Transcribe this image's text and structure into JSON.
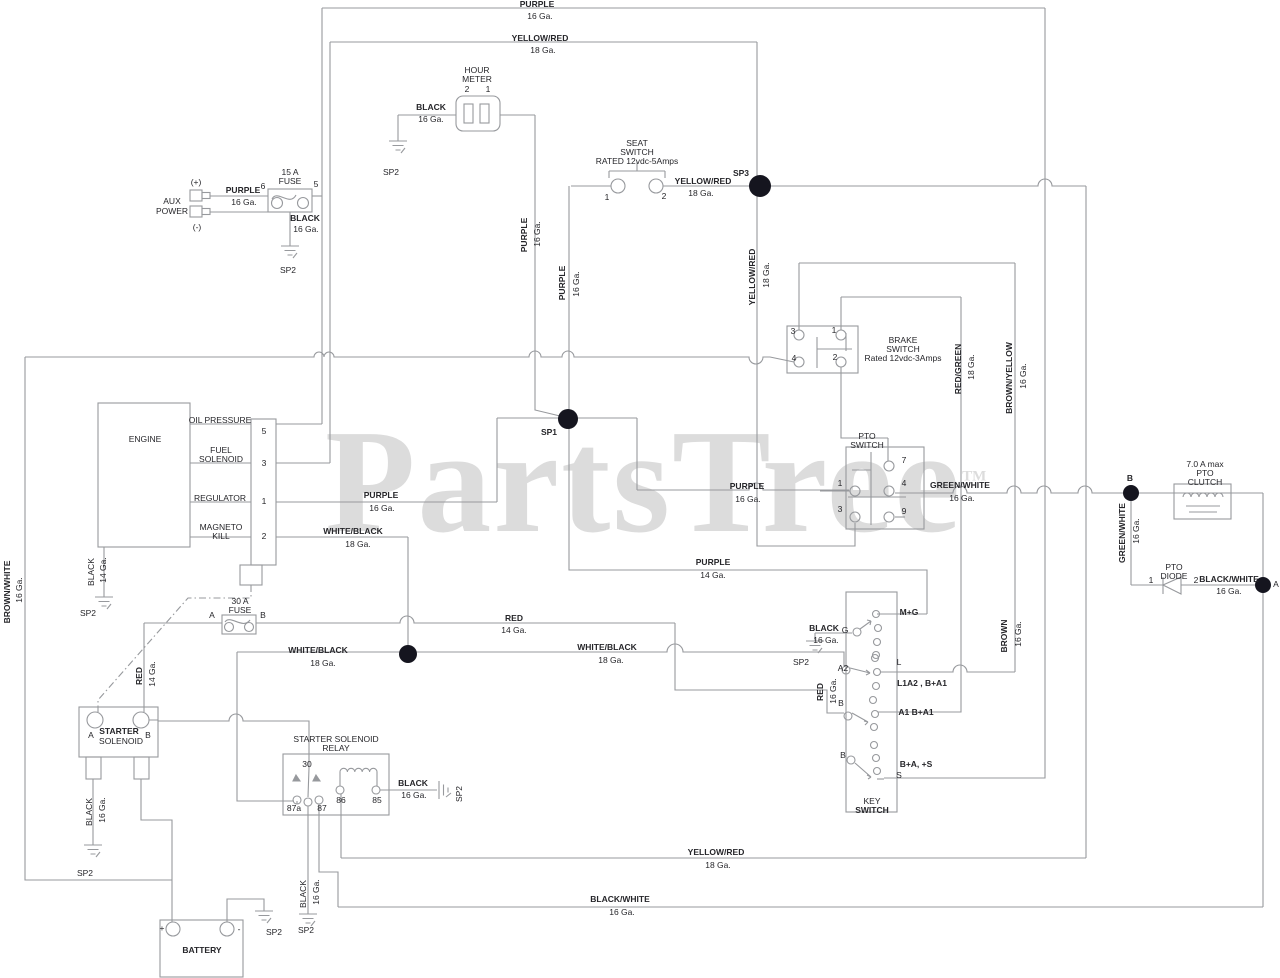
{
  "document": {
    "type": "electrical wiring schematic",
    "source_watermark": "PartsTree"
  },
  "watermark": {
    "text": "PartsTree",
    "tm": "TM"
  },
  "colors": {
    "wire": "#97999d",
    "text": "#26262a",
    "junction_dot": "#15151f",
    "watermark": "#dcdcdc"
  },
  "components": [
    "HOUR METER",
    "AUX POWER",
    "15 A FUSE",
    "SEAT SWITCH RATED 12vdc-5Amps",
    "BRAKE SWITCH Rated 12vdc-3Amps",
    "ENGINE",
    "PTO SWITCH",
    "7.0 A max PTO CLUTCH",
    "PTO DIODE",
    "KEY SWITCH",
    "30 A FUSE",
    "STARTER SOLENOID",
    "STARTER SOLENOID RELAY",
    "BATTERY"
  ],
  "junctions": [
    "SP1",
    "SP3",
    "A",
    "B"
  ],
  "grounds": [
    "SP2"
  ],
  "labels": [
    {
      "t": "PURPLE",
      "x": 537,
      "y": 4,
      "b": 1,
      "r": 0
    },
    {
      "t": "16 Ga.",
      "x": 540,
      "y": 16,
      "b": 0,
      "r": 0
    },
    {
      "t": "YELLOW/RED",
      "x": 540,
      "y": 38,
      "b": 1,
      "r": 0
    },
    {
      "t": "18 Ga.",
      "x": 543,
      "y": 50,
      "b": 0,
      "r": 0
    },
    {
      "t": "HOUR",
      "x": 477,
      "y": 70,
      "b": 0,
      "r": 0
    },
    {
      "t": "METER",
      "x": 477,
      "y": 79,
      "b": 0,
      "r": 0
    },
    {
      "t": "2",
      "x": 467,
      "y": 89,
      "b": 0,
      "r": 0
    },
    {
      "t": "1",
      "x": 488,
      "y": 89,
      "b": 0,
      "r": 0
    },
    {
      "t": "BLACK",
      "x": 431,
      "y": 107,
      "b": 1,
      "r": 0
    },
    {
      "t": "16 Ga.",
      "x": 431,
      "y": 119,
      "b": 0,
      "r": 0
    },
    {
      "t": "SP2",
      "x": 391,
      "y": 172,
      "b": 0,
      "r": 0
    },
    {
      "t": "(+)",
      "x": 196,
      "y": 182,
      "b": 0,
      "r": 0
    },
    {
      "t": "AUX",
      "x": 172,
      "y": 201,
      "b": 0,
      "r": 0
    },
    {
      "t": "POWER",
      "x": 172,
      "y": 211,
      "b": 0,
      "r": 0
    },
    {
      "t": "(-)",
      "x": 197,
      "y": 227,
      "b": 0,
      "r": 0
    },
    {
      "t": "PURPLE",
      "x": 243,
      "y": 190,
      "b": 1,
      "r": 0
    },
    {
      "t": "16 Ga.",
      "x": 244,
      "y": 202,
      "b": 0,
      "r": 0
    },
    {
      "t": "15 A",
      "x": 290,
      "y": 172,
      "b": 0,
      "r": 0
    },
    {
      "t": "FUSE",
      "x": 290,
      "y": 181,
      "b": 0,
      "r": 0
    },
    {
      "t": "6",
      "x": 263,
      "y": 186,
      "b": 0,
      "r": 0
    },
    {
      "t": "5",
      "x": 316,
      "y": 184,
      "b": 0,
      "r": 0
    },
    {
      "t": "BLACK",
      "x": 305,
      "y": 218,
      "b": 1,
      "r": 0
    },
    {
      "t": "16 Ga.",
      "x": 306,
      "y": 229,
      "b": 0,
      "r": 0
    },
    {
      "t": "SP2",
      "x": 288,
      "y": 270,
      "b": 0,
      "r": 0
    },
    {
      "t": "SEAT",
      "x": 637,
      "y": 143,
      "b": 0,
      "r": 0
    },
    {
      "t": "SWITCH",
      "x": 637,
      "y": 152,
      "b": 0,
      "r": 0
    },
    {
      "t": "RATED 12vdc-5Amps",
      "x": 637,
      "y": 161,
      "b": 0,
      "r": 0
    },
    {
      "t": "1",
      "x": 607,
      "y": 197,
      "b": 0,
      "r": 0
    },
    {
      "t": "2",
      "x": 664,
      "y": 196,
      "b": 0,
      "r": 0
    },
    {
      "t": "YELLOW/RED",
      "x": 703,
      "y": 181,
      "b": 1,
      "r": 0
    },
    {
      "t": "18 Ga.",
      "x": 701,
      "y": 193,
      "b": 0,
      "r": 0
    },
    {
      "t": "SP3",
      "x": 741,
      "y": 173,
      "b": 1,
      "r": 0
    },
    {
      "t": "YELLOW/RED",
      "x": 752,
      "y": 277,
      "b": 1,
      "r": 1
    },
    {
      "t": "18 Ga.",
      "x": 766,
      "y": 275,
      "b": 0,
      "r": 1
    },
    {
      "t": "3",
      "x": 793,
      "y": 331,
      "b": 0,
      "r": 0
    },
    {
      "t": "1",
      "x": 834,
      "y": 330,
      "b": 0,
      "r": 0
    },
    {
      "t": "4",
      "x": 794,
      "y": 358,
      "b": 0,
      "r": 0
    },
    {
      "t": "2",
      "x": 835,
      "y": 357,
      "b": 0,
      "r": 0
    },
    {
      "t": "BRAKE",
      "x": 903,
      "y": 340,
      "b": 0,
      "r": 0
    },
    {
      "t": "SWITCH",
      "x": 903,
      "y": 349,
      "b": 0,
      "r": 0
    },
    {
      "t": "Rated 12vdc-3Amps",
      "x": 903,
      "y": 358,
      "b": 0,
      "r": 0
    },
    {
      "t": "RED/GREEN",
      "x": 958,
      "y": 369,
      "b": 1,
      "r": 1
    },
    {
      "t": "18 Ga.",
      "x": 971,
      "y": 367,
      "b": 0,
      "r": 1
    },
    {
      "t": "BROWN/YELLOW",
      "x": 1009,
      "y": 378,
      "b": 1,
      "r": 1
    },
    {
      "t": "16 Ga.",
      "x": 1023,
      "y": 376,
      "b": 0,
      "r": 1
    },
    {
      "t": "ENGINE",
      "x": 145,
      "y": 439,
      "b": 0,
      "r": 0
    },
    {
      "t": "OIL PRESSURE",
      "x": 220,
      "y": 420,
      "b": 0,
      "r": 0
    },
    {
      "t": "FUEL",
      "x": 221,
      "y": 450,
      "b": 0,
      "r": 0
    },
    {
      "t": "SOLENOID",
      "x": 221,
      "y": 459,
      "b": 0,
      "r": 0
    },
    {
      "t": "REGULATOR",
      "x": 220,
      "y": 498,
      "b": 0,
      "r": 0
    },
    {
      "t": "MAGNETO",
      "x": 221,
      "y": 527,
      "b": 0,
      "r": 0
    },
    {
      "t": "KILL",
      "x": 221,
      "y": 536,
      "b": 0,
      "r": 0
    },
    {
      "t": "5",
      "x": 264,
      "y": 431,
      "b": 0,
      "r": 0
    },
    {
      "t": "3",
      "x": 264,
      "y": 463,
      "b": 0,
      "r": 0
    },
    {
      "t": "1",
      "x": 264,
      "y": 501,
      "b": 0,
      "r": 0
    },
    {
      "t": "2",
      "x": 264,
      "y": 536,
      "b": 0,
      "r": 0
    },
    {
      "t": "BLACK",
      "x": 91,
      "y": 572,
      "b": 0,
      "r": 1
    },
    {
      "t": "14 Ga.",
      "x": 103,
      "y": 570,
      "b": 0,
      "r": 1
    },
    {
      "t": "SP2",
      "x": 88,
      "y": 613,
      "b": 0,
      "r": 0
    },
    {
      "t": "PURPLE",
      "x": 381,
      "y": 495,
      "b": 1,
      "r": 0
    },
    {
      "t": "16 Ga.",
      "x": 382,
      "y": 508,
      "b": 0,
      "r": 0
    },
    {
      "t": "WHITE/BLACK",
      "x": 353,
      "y": 531,
      "b": 1,
      "r": 0
    },
    {
      "t": "18 Ga.",
      "x": 358,
      "y": 544,
      "b": 0,
      "r": 0
    },
    {
      "t": "SP1",
      "x": 549,
      "y": 432,
      "b": 1,
      "r": 0
    },
    {
      "t": "PURPLE",
      "x": 524,
      "y": 235,
      "b": 1,
      "r": 1
    },
    {
      "t": "16 Ga.",
      "x": 537,
      "y": 234,
      "b": 0,
      "r": 1
    },
    {
      "t": "PURPLE",
      "x": 562,
      "y": 283,
      "b": 1,
      "r": 1
    },
    {
      "t": "16 Ga.",
      "x": 576,
      "y": 284,
      "b": 0,
      "r": 1
    },
    {
      "t": "PURPLE",
      "x": 747,
      "y": 486,
      "b": 1,
      "r": 0
    },
    {
      "t": "16 Ga.",
      "x": 748,
      "y": 499,
      "b": 0,
      "r": 0
    },
    {
      "t": "PTO",
      "x": 867,
      "y": 436,
      "b": 0,
      "r": 0
    },
    {
      "t": "SWITCH",
      "x": 867,
      "y": 445,
      "b": 0,
      "r": 0
    },
    {
      "t": "7",
      "x": 904,
      "y": 460,
      "b": 0,
      "r": 0
    },
    {
      "t": "1",
      "x": 840,
      "y": 483,
      "b": 0,
      "r": 0
    },
    {
      "t": "4",
      "x": 904,
      "y": 483,
      "b": 0,
      "r": 0
    },
    {
      "t": "3",
      "x": 840,
      "y": 509,
      "b": 0,
      "r": 0
    },
    {
      "t": "9",
      "x": 904,
      "y": 511,
      "b": 0,
      "r": 0
    },
    {
      "t": "GREEN/WHITE",
      "x": 960,
      "y": 485,
      "b": 1,
      "r": 0
    },
    {
      "t": "16 Ga.",
      "x": 962,
      "y": 498,
      "b": 0,
      "r": 0
    },
    {
      "t": "PURPLE",
      "x": 713,
      "y": 562,
      "b": 1,
      "r": 0
    },
    {
      "t": "14 Ga.",
      "x": 713,
      "y": 575,
      "b": 0,
      "r": 0
    },
    {
      "t": "7.0 A max",
      "x": 1205,
      "y": 464,
      "b": 0,
      "r": 0
    },
    {
      "t": "PTO",
      "x": 1205,
      "y": 473,
      "b": 0,
      "r": 0
    },
    {
      "t": "CLUTCH",
      "x": 1205,
      "y": 482,
      "b": 0,
      "r": 0
    },
    {
      "t": "B",
      "x": 1130,
      "y": 478,
      "b": 1,
      "r": 0
    },
    {
      "t": "GREEN/WHITE",
      "x": 1122,
      "y": 533,
      "b": 1,
      "r": 1
    },
    {
      "t": "16 Ga.",
      "x": 1136,
      "y": 531,
      "b": 0,
      "r": 1
    },
    {
      "t": "PTO",
      "x": 1174,
      "y": 567,
      "b": 0,
      "r": 0
    },
    {
      "t": "DIODE",
      "x": 1174,
      "y": 576,
      "b": 0,
      "r": 0
    },
    {
      "t": "1",
      "x": 1151,
      "y": 580,
      "b": 0,
      "r": 0
    },
    {
      "t": "2",
      "x": 1196,
      "y": 580,
      "b": 0,
      "r": 0
    },
    {
      "t": "BLACK/WHITE",
      "x": 1229,
      "y": 579,
      "b": 1,
      "r": 0
    },
    {
      "t": "16 Ga.",
      "x": 1229,
      "y": 591,
      "b": 0,
      "r": 0
    },
    {
      "t": "A",
      "x": 1276,
      "y": 584,
      "b": 0,
      "r": 0
    },
    {
      "t": "BLACK",
      "x": 824,
      "y": 628,
      "b": 1,
      "r": 0
    },
    {
      "t": "16 Ga.",
      "x": 826,
      "y": 640,
      "b": 0,
      "r": 0
    },
    {
      "t": "SP2",
      "x": 801,
      "y": 662,
      "b": 0,
      "r": 0
    },
    {
      "t": "G",
      "x": 845,
      "y": 630,
      "b": 0,
      "r": 0
    },
    {
      "t": "M+G",
      "x": 909,
      "y": 612,
      "b": 1,
      "r": 0
    },
    {
      "t": "A2",
      "x": 843,
      "y": 668,
      "b": 0,
      "r": 0
    },
    {
      "t": "L",
      "x": 899,
      "y": 662,
      "b": 0,
      "r": 0
    },
    {
      "t": "L1A2 , B+A1",
      "x": 922,
      "y": 683,
      "b": 1,
      "r": 0
    },
    {
      "t": "B",
      "x": 841,
      "y": 703,
      "b": 0,
      "r": 0
    },
    {
      "t": "A1 B+A1",
      "x": 916,
      "y": 712,
      "b": 1,
      "r": 0
    },
    {
      "t": "B",
      "x": 843,
      "y": 755,
      "b": 0,
      "r": 0
    },
    {
      "t": "B+A, +S",
      "x": 916,
      "y": 764,
      "b": 1,
      "r": 0
    },
    {
      "t": "S",
      "x": 899,
      "y": 775,
      "b": 0,
      "r": 0
    },
    {
      "t": "KEY",
      "x": 872,
      "y": 801,
      "b": 0,
      "r": 0
    },
    {
      "t": "SWITCH",
      "x": 872,
      "y": 810,
      "b": 1,
      "r": 0
    },
    {
      "t": "RED",
      "x": 820,
      "y": 692,
      "b": 1,
      "r": 1
    },
    {
      "t": "16 Ga.",
      "x": 833,
      "y": 691,
      "b": 0,
      "r": 1
    },
    {
      "t": "BROWN",
      "x": 1004,
      "y": 636,
      "b": 1,
      "r": 1
    },
    {
      "t": "16 Ga.",
      "x": 1018,
      "y": 634,
      "b": 0,
      "r": 1
    },
    {
      "t": "RED",
      "x": 514,
      "y": 618,
      "b": 1,
      "r": 0
    },
    {
      "t": "14 Ga.",
      "x": 514,
      "y": 630,
      "b": 0,
      "r": 0
    },
    {
      "t": "WHITE/BLACK",
      "x": 318,
      "y": 650,
      "b": 1,
      "r": 0
    },
    {
      "t": "18 Ga.",
      "x": 323,
      "y": 663,
      "b": 0,
      "r": 0
    },
    {
      "t": "WHITE/BLACK",
      "x": 607,
      "y": 647,
      "b": 1,
      "r": 0
    },
    {
      "t": "18 Ga.",
      "x": 611,
      "y": 660,
      "b": 0,
      "r": 0
    },
    {
      "t": "30 A",
      "x": 240,
      "y": 601,
      "b": 0,
      "r": 0
    },
    {
      "t": "FUSE",
      "x": 240,
      "y": 610,
      "b": 0,
      "r": 0
    },
    {
      "t": "A",
      "x": 212,
      "y": 615,
      "b": 0,
      "r": 0
    },
    {
      "t": "B",
      "x": 263,
      "y": 615,
      "b": 0,
      "r": 0
    },
    {
      "t": "STARTER",
      "x": 119,
      "y": 731,
      "b": 1,
      "r": 0
    },
    {
      "t": "SOLENOID",
      "x": 121,
      "y": 741,
      "b": 0,
      "r": 0
    },
    {
      "t": "A",
      "x": 91,
      "y": 735,
      "b": 0,
      "r": 0
    },
    {
      "t": "B",
      "x": 148,
      "y": 735,
      "b": 0,
      "r": 0
    },
    {
      "t": "BLACK",
      "x": 89,
      "y": 812,
      "b": 0,
      "r": 1
    },
    {
      "t": "16 Ga.",
      "x": 102,
      "y": 810,
      "b": 0,
      "r": 1
    },
    {
      "t": "SP2",
      "x": 85,
      "y": 873,
      "b": 0,
      "r": 0
    },
    {
      "t": "RED",
      "x": 139,
      "y": 676,
      "b": 1,
      "r": 1
    },
    {
      "t": "14 Ga.",
      "x": 152,
      "y": 674,
      "b": 0,
      "r": 1
    },
    {
      "t": "STARTER SOLENOID",
      "x": 336,
      "y": 739,
      "b": 0,
      "r": 0
    },
    {
      "t": "RELAY",
      "x": 336,
      "y": 748,
      "b": 0,
      "r": 0
    },
    {
      "t": "30",
      "x": 307,
      "y": 764,
      "b": 0,
      "r": 0
    },
    {
      "t": "87a",
      "x": 294,
      "y": 808,
      "b": 0,
      "r": 0
    },
    {
      "t": "87",
      "x": 322,
      "y": 808,
      "b": 0,
      "r": 0
    },
    {
      "t": "86",
      "x": 341,
      "y": 800,
      "b": 0,
      "r": 0
    },
    {
      "t": "85",
      "x": 377,
      "y": 800,
      "b": 0,
      "r": 0
    },
    {
      "t": "BLACK",
      "x": 413,
      "y": 783,
      "b": 1,
      "r": 0
    },
    {
      "t": "16 Ga.",
      "x": 414,
      "y": 795,
      "b": 0,
      "r": 0
    },
    {
      "t": "SP2",
      "x": 459,
      "y": 794,
      "b": 0,
      "r": 1
    },
    {
      "t": "YELLOW/RED",
      "x": 716,
      "y": 852,
      "b": 1,
      "r": 0
    },
    {
      "t": "18 Ga.",
      "x": 718,
      "y": 865,
      "b": 0,
      "r": 0
    },
    {
      "t": "BLACK/WHITE",
      "x": 620,
      "y": 899,
      "b": 1,
      "r": 0
    },
    {
      "t": "16 Ga.",
      "x": 622,
      "y": 912,
      "b": 0,
      "r": 0
    },
    {
      "t": "BLACK",
      "x": 303,
      "y": 894,
      "b": 0,
      "r": 1
    },
    {
      "t": "16 Ga.",
      "x": 316,
      "y": 892,
      "b": 0,
      "r": 1
    },
    {
      "t": "SP2",
      "x": 306,
      "y": 930,
      "b": 0,
      "r": 0
    },
    {
      "t": "SP2",
      "x": 274,
      "y": 932,
      "b": 0,
      "r": 0
    },
    {
      "t": "+",
      "x": 162,
      "y": 928,
      "b": 0,
      "r": 0
    },
    {
      "t": "-",
      "x": 239,
      "y": 929,
      "b": 0,
      "r": 0
    },
    {
      "t": "BATTERY",
      "x": 202,
      "y": 950,
      "b": 1,
      "r": 0
    },
    {
      "t": "BROWN/WHITE",
      "x": 7,
      "y": 592,
      "b": 1,
      "r": 1
    },
    {
      "t": "16 Ga.",
      "x": 19,
      "y": 590,
      "b": 0,
      "r": 1
    }
  ]
}
